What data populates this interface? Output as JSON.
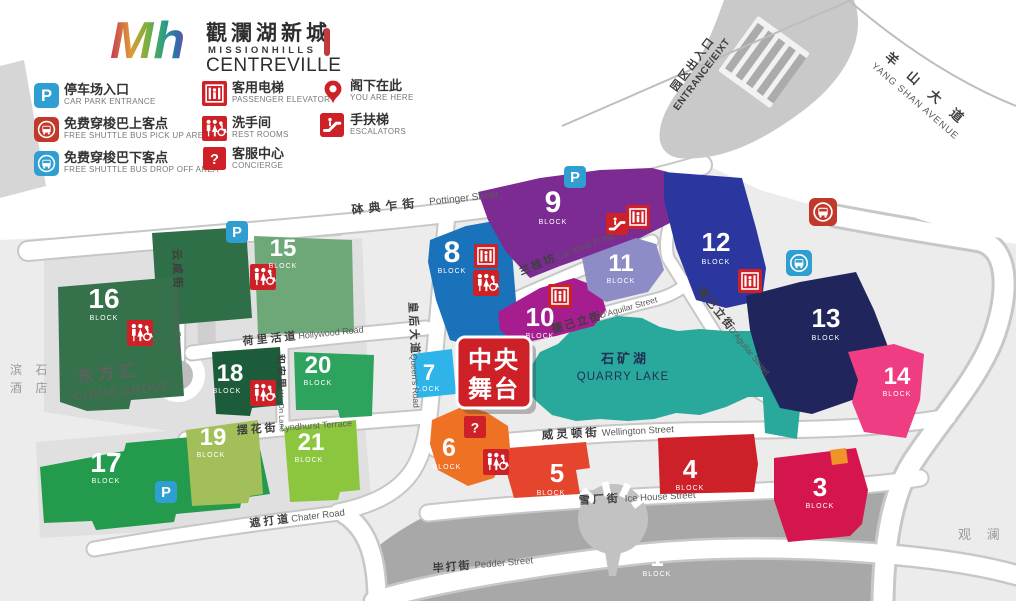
{
  "logo": {
    "script": "Mh",
    "cn": "觀瀾湖新城",
    "en_line1": "MISSIONHILLS",
    "en_line2": "CENTREVILLE"
  },
  "legend": {
    "items": [
      {
        "icon": "parking-icon",
        "cn": "停车场入口",
        "en": "CAR PARK ENTRANCE"
      },
      {
        "icon": "shuttle-bus-pickup-icon",
        "cn": "免费穿梭巴上客点",
        "en": "FREE SHUTTLE BUS PICK UP AREA"
      },
      {
        "icon": "shuttle-bus-dropoff-icon",
        "cn": "免费穿梭巴下客点",
        "en": "FREE SHUTTLE BUS DROP OFF AREA"
      },
      {
        "icon": "elevator-icon",
        "cn": "客用电梯",
        "en": "PASSENGER ELEVATOR"
      },
      {
        "icon": "restroom-icon",
        "cn": "洗手间",
        "en": "REST ROOMS"
      },
      {
        "icon": "concierge-icon",
        "cn": "客服中心",
        "en": "CONCIERGE"
      },
      {
        "icon": "location-pin-icon",
        "cn": "阁下在此",
        "en": "YOU ARE HERE"
      },
      {
        "icon": "escalator-icon",
        "cn": "手扶梯",
        "en": "ESCALATORS"
      }
    ]
  },
  "icons": {
    "parking_glyph": "P",
    "concierge_glyph": "?"
  },
  "map": {
    "central_stage": {
      "line1": "中央",
      "line2": "舞台"
    },
    "block_label": "BLOCK",
    "blocks": {
      "n1": "1",
      "n3": "3",
      "n4": "4",
      "n5": "5",
      "n6": "6",
      "n7": "7",
      "n8": "8",
      "n9": "9",
      "n10": "10",
      "n11": "11",
      "n12": "12",
      "n13": "13",
      "n14": "14",
      "n15": "15",
      "n16": "16",
      "n17": "17",
      "n18": "18",
      "n19": "19",
      "n20": "20",
      "n21": "21"
    },
    "areas": {
      "china_grove": {
        "cn": "东方汇",
        "en": "CHINA GROVE"
      },
      "quarry_lake": {
        "cn": "石矿湖",
        "en": "QUARRY LAKE"
      },
      "hotel_left": {
        "line1": "滨 石",
        "line2": "酒 店"
      },
      "right_edge": {
        "text": "观 澜 湖"
      },
      "entrance": {
        "cn": "园区出入口",
        "en": "ENTRANCE/EIXT"
      }
    },
    "streets": {
      "pottinger": {
        "cn": "砵典乍街",
        "en": "Pottinger Street"
      },
      "wyndham": {
        "cn": "云咸街",
        "en": "Wyndham Street"
      },
      "hollywood": {
        "cn": "荷里活道",
        "en": "Hollywood Road"
      },
      "wo_on_lane": {
        "cn": "和安里",
        "en": "Wo On Lane"
      },
      "lyndhurst": {
        "cn": "摆花街",
        "en": "Lyndhurst Terrace"
      },
      "queens": {
        "cn": "皇后大道",
        "en": "Queen's Road"
      },
      "chater": {
        "cn": "遮打道",
        "en": "Chater Road"
      },
      "lan_kwai_fong": {
        "cn": "兰桂坊",
        "en": "Lan Kwai Fong"
      },
      "daguilar": {
        "cn": "德己立街",
        "en": "D'Aguilar Street"
      },
      "wellington": {
        "cn": "威灵顿街",
        "en": "Wellington Street"
      },
      "ice_house": {
        "cn": "雪厂街",
        "en": "Ice House Street"
      },
      "pedder": {
        "cn": "毕打街",
        "en": "Pedder Street"
      },
      "yang_shan": {
        "cn": "羊 山 大 道",
        "en": "YANG SHAN AVENUE"
      }
    },
    "colors": {
      "brand_red": "#ce2027",
      "parking_blue": "#2e9fd0",
      "shuttle_pickup_red": "#c0392b",
      "shuttle_dropoff_blue": "#2e9fd0",
      "lake_teal": "#29a89c",
      "stage_red": "#ce2027",
      "notch_orange": "#f09429",
      "b1_plaza": "#a8a8a8",
      "b3": "#d5164e",
      "b4": "#ce2029",
      "b5": "#e5452c",
      "b6": "#ef7123",
      "b7": "#2fb4e9",
      "b8": "#1a73ba",
      "b9": "#7c2b93",
      "b10": "#a51d8e",
      "b11": "#8d8cc6",
      "b12": "#2b379e",
      "b13": "#20265c",
      "b14": "#ee3d83",
      "b15": "#2f6f47",
      "b15_annex": "#6fa878",
      "b16": "#35724c",
      "b17": "#239a4c",
      "b18": "#1d5c3b",
      "b19": "#a3bf5a",
      "b20": "#2ea35e",
      "b21": "#8cc63f"
    }
  }
}
